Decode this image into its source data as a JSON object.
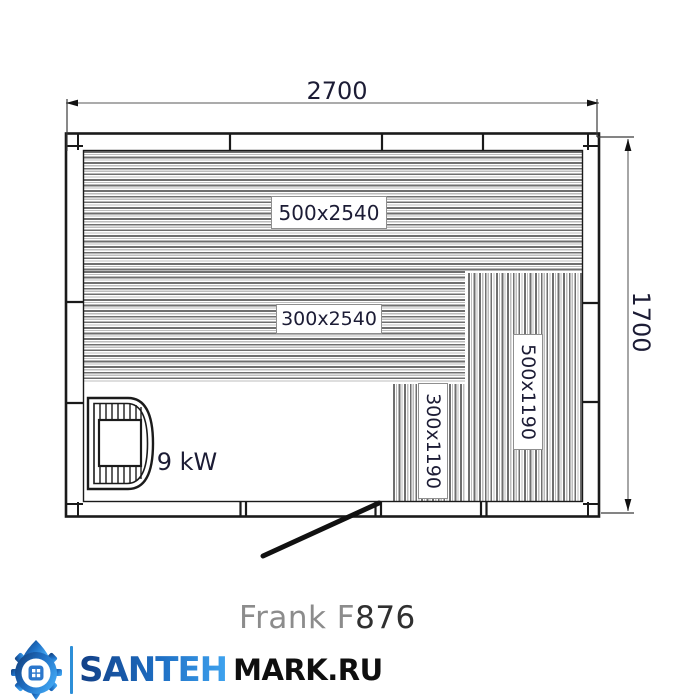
{
  "drawing": {
    "dim_width": "2700",
    "dim_height": "1700",
    "heater_power": "9 kW",
    "benches": [
      {
        "label": "500x2540",
        "orientation": "horizontal"
      },
      {
        "label": "300x2540",
        "orientation": "horizontal"
      },
      {
        "label": "500x1190",
        "orientation": "vertical"
      },
      {
        "label": "300x1190",
        "orientation": "vertical"
      }
    ],
    "model_prefix": "Frank F",
    "model_suffix": "876"
  },
  "branding": {
    "logo_icon": "gear-house-logo-icon",
    "name_part1": "SANTEH",
    "name_part2": "MARK.RU",
    "accent_blue": "#2d8fd8",
    "dark_blue": "#123f86",
    "text_black": "#0f0f0f"
  }
}
